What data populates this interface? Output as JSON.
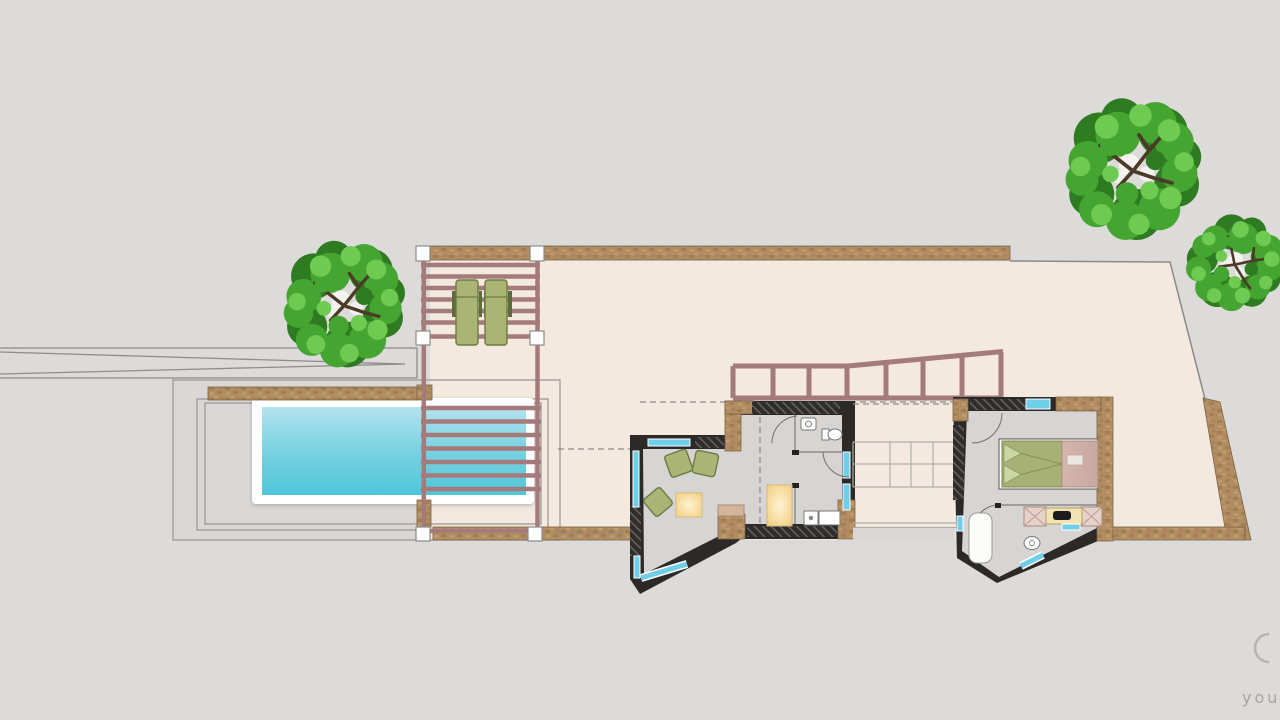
{
  "watermark": {
    "text": "you"
  },
  "colors": {
    "background": "#dcdbd9",
    "terrace": "#f3e9de",
    "deck": "#d9d8d6",
    "line_gray": "#9a9998",
    "pergola": "#a47a7b",
    "stone": "#b28d61",
    "stone_dark": "#8f6f45",
    "stone_light": "#c9a878",
    "wall": "#2b2a28",
    "floor": "#d6d5d3",
    "window": "#6fcfe8",
    "water_top": "#b3e3ee",
    "water_mid": "#7ed3e2",
    "water_bottom": "#4fc6da",
    "furniture_green": "#a9b475",
    "bed_green": "#a8b174",
    "bed_pillow": "#ccd6a4",
    "bed_pink": "#c7a79f",
    "table_glow_in": "#fdf3d3",
    "table_glow_out": "#f2cd7e",
    "bench_tan": "#d4b49a",
    "cabinet_pink": "#e7d2ca",
    "tree_dark": "#2e7b22",
    "tree_mid": "#45a531",
    "tree_light": "#6fca52",
    "tree_branch": "#4b3a26",
    "watermark": "#a9a49c"
  }
}
